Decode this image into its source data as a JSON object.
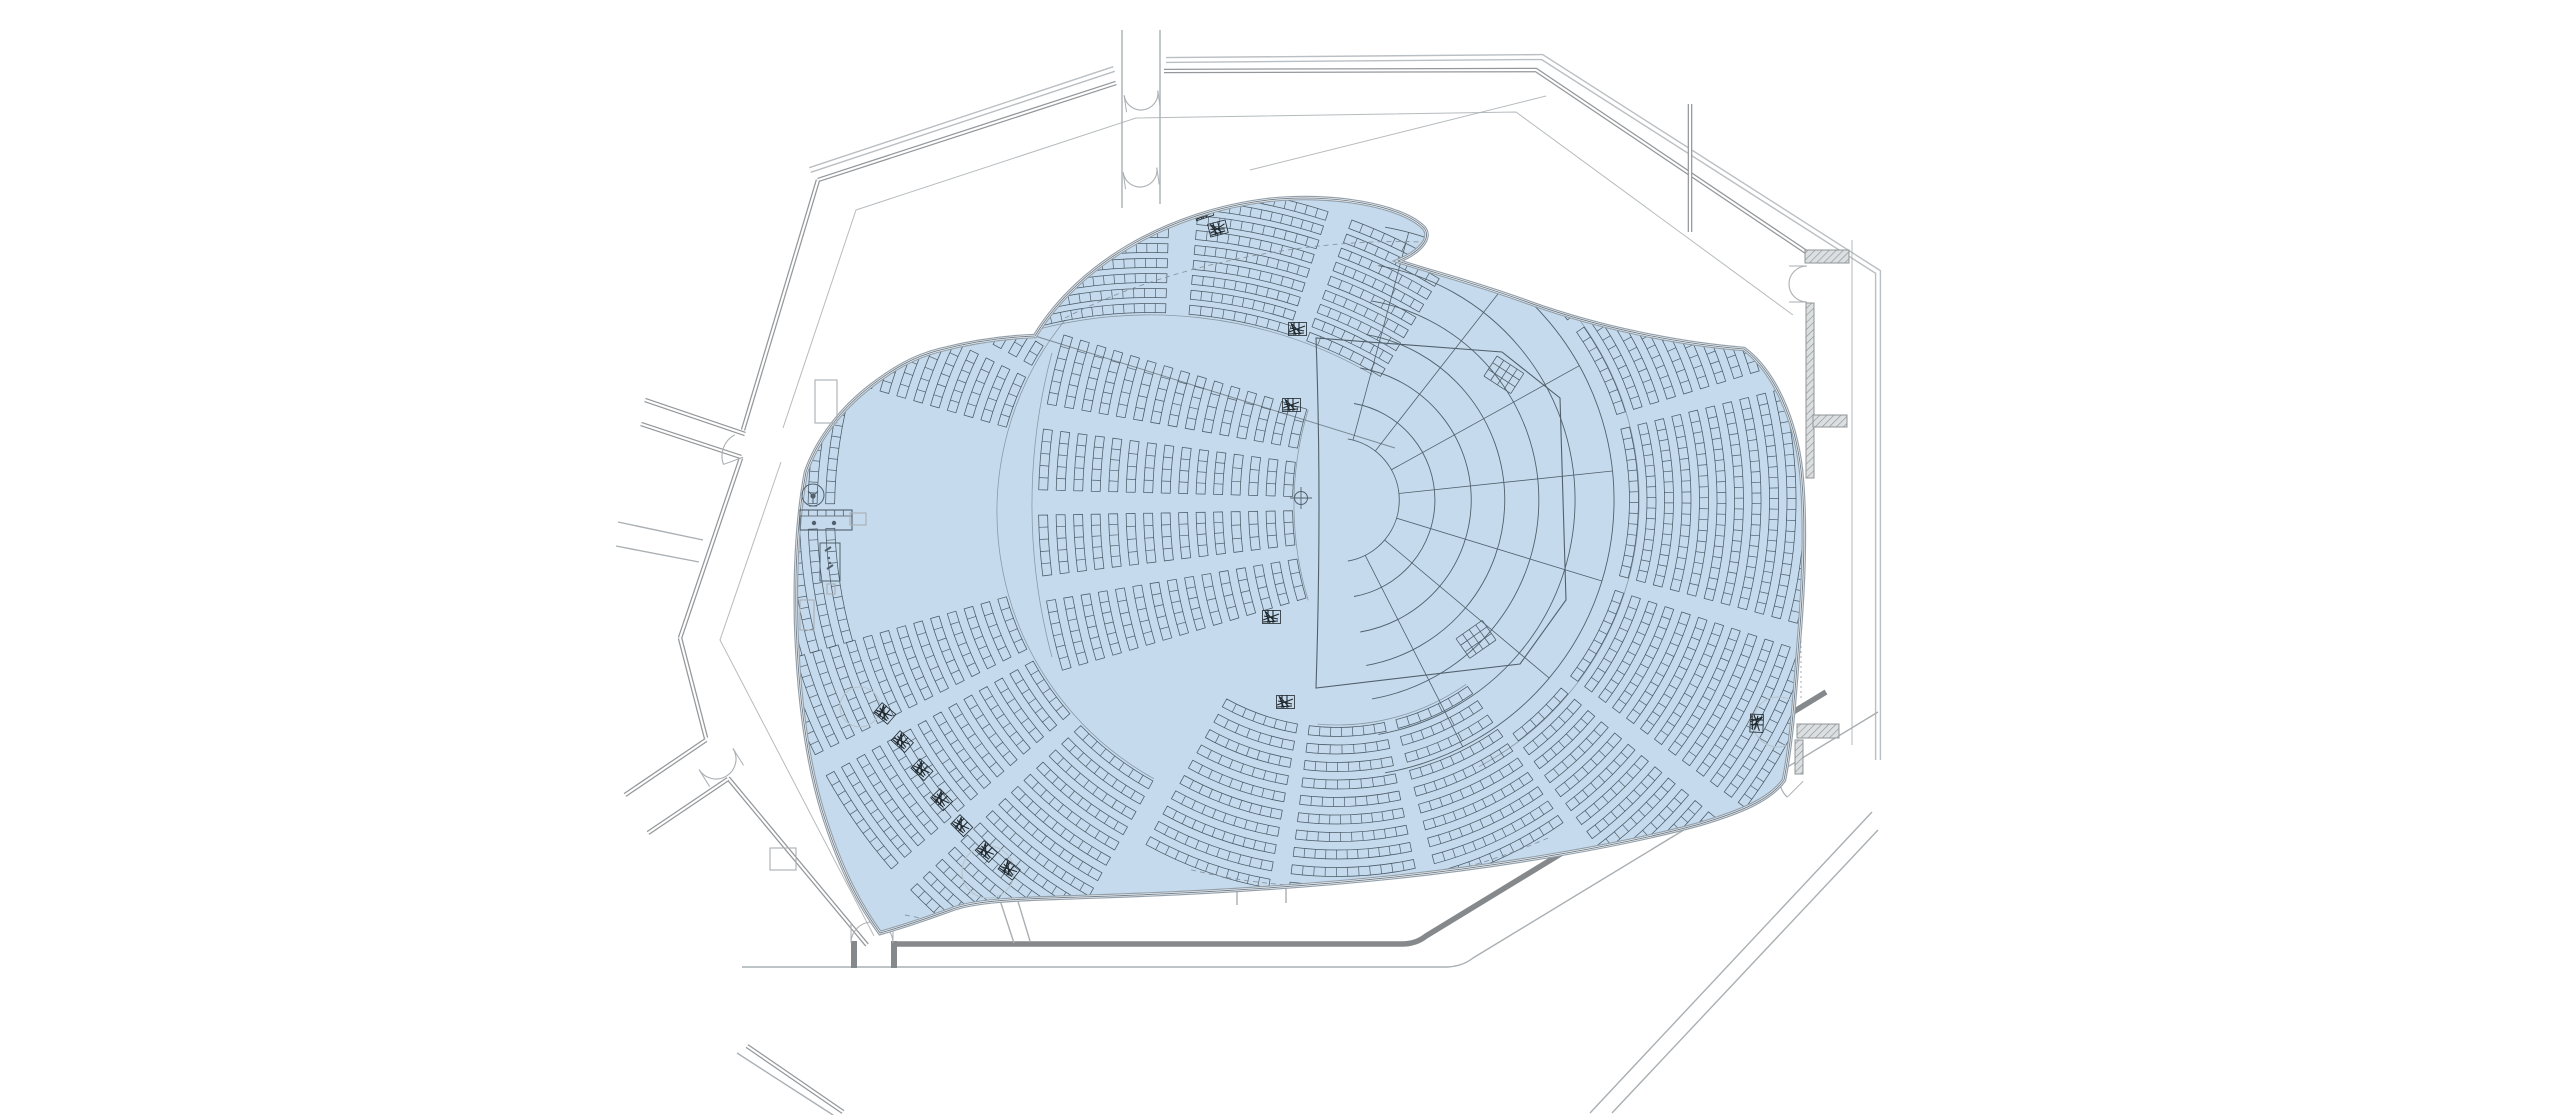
{
  "diagram": {
    "type": "architectural-floor-plan",
    "subject": "concert-hall-auditorium-seating-plan",
    "canvas": {
      "width": 2560,
      "height": 1115,
      "background": "#ffffff"
    },
    "colors": {
      "highlight_fill": "#c5dbed",
      "bowl_edge_outer": "#93a0ab",
      "bowl_edge_inner": "#74828e",
      "seat_line": "#3d4b58",
      "stage_line": "#51606c",
      "aisle_line": "#7b8a96",
      "wall_dark": "#85898c",
      "wall_mid": "#94989b",
      "wall_thin": "#a9afb3",
      "wall_skin": "#babfc3",
      "hatch_fill": "#dcdfe1",
      "hatch_line": "#8f9497",
      "dashed_line": "#8796a3",
      "scribble": "#20272d",
      "faint_circle": "#b6c3ce",
      "white": "#ffffff"
    },
    "bowl": {
      "path": "M1035,336 C1080,262 1170,212 1268,200 C1330,193 1402,205 1424,228 C1432,238 1420,252 1398,261 C1430,272 1470,281 1530,303 C1600,328 1680,344 1744,349 C1775,372 1795,420 1801,470 C1806,520 1804,580 1799,640 C1795,690 1792,740 1784,780 C1770,800 1740,812 1700,824 C1620,846 1500,866 1395,877 C1290,888 1180,894 1080,897 C1020,899 975,900 950,910 C928,918 898,928 880,933 C856,900 838,862 822,810 C806,756 798,690 796,620 C795,570 797,520 806,472 C818,438 842,408 872,385 C892,370 912,357 940,350 C975,341 1008,337 1035,336 Z"
    },
    "walls": [
      {
        "name": "skin-top-left",
        "style": "skin",
        "d": "M810,170 L1114,69"
      },
      {
        "name": "skin-top-right",
        "style": "skin",
        "d": "M1166,60 L1542,57 L1878,272 L1878,760"
      },
      {
        "name": "wall-top-left",
        "style": "dbl",
        "d": "M818,180 L1116,83"
      },
      {
        "name": "wall-top-right",
        "style": "dbl",
        "d": "M1164,71 L1536,70 L1821,262"
      },
      {
        "name": "wall-left-upper",
        "style": "dbl",
        "d": "M818,180 L743,430"
      },
      {
        "name": "wall-left-mid",
        "style": "dbl",
        "d": "M741,458 L680,638"
      },
      {
        "name": "wall-left-lower-a",
        "style": "dbl",
        "d": "M680,638 L706,738"
      },
      {
        "name": "wall-left-lower-b",
        "style": "dbl",
        "d": "M728,778 L867,945"
      },
      {
        "name": "corridor-upper-left-wall-a",
        "style": "dbl",
        "d": "M645,400 L745,434"
      },
      {
        "name": "corridor-upper-left-wall-b",
        "style": "dbl",
        "d": "M641,424 L741,457"
      },
      {
        "name": "corridor-left-horizontal-a",
        "style": "thin",
        "d": "M618,522 L703,540"
      },
      {
        "name": "corridor-left-horizontal-b",
        "style": "thin",
        "d": "M616,546 L699,562"
      },
      {
        "name": "corridor-lower-left-wall-a",
        "style": "dbl",
        "d": "M706,740 L625,795"
      },
      {
        "name": "corridor-lower-left-wall-b",
        "style": "dbl",
        "d": "M728,779 L648,833"
      },
      {
        "name": "wall-bottom-left-diag",
        "style": "dbl",
        "d": "M747,1046 L843,1112"
      },
      {
        "name": "wall-bottom-left-diag-thin",
        "style": "thin",
        "d": "M737,1053 L833,1115"
      },
      {
        "name": "corridor-top-wall-a",
        "style": "thin",
        "d": "M1122,30 L1122,208"
      },
      {
        "name": "corridor-top-wall-b",
        "style": "thin",
        "d": "M1160,30 L1160,204"
      },
      {
        "name": "band-bottom-dark",
        "style": "band",
        "d": "M897,944 L1402,944 Q1416,944 1426,936 L1826,692"
      },
      {
        "name": "band-bottom-thin",
        "style": "thin",
        "d": "M742,967 L1448,967 Q1463,966 1473,958 L1878,712"
      },
      {
        "name": "diag-bottom-right-a",
        "style": "thin",
        "d": "M1590,1113 L1872,812"
      },
      {
        "name": "diag-bottom-right-b",
        "style": "thin",
        "d": "M1612,1113 L1878,830"
      },
      {
        "name": "stub-bottom-center-a",
        "style": "thin",
        "d": "M1237,847 L1237,905"
      },
      {
        "name": "stub-bottom-center-b",
        "style": "thin",
        "d": "M1286,845 L1286,903"
      },
      {
        "name": "stub-bottom-diag-a",
        "style": "thin",
        "d": "M996,888 L1014,943"
      },
      {
        "name": "stub-bottom-diag-b",
        "style": "thin",
        "d": "M1013,885 L1030,941"
      },
      {
        "name": "foyer-line-top",
        "style": "foyer",
        "d": "M856,210 L1136,118 L1516,112 L1793,315"
      },
      {
        "name": "foyer-line-left-upper",
        "style": "foyer",
        "d": "M856,210 L783,428"
      },
      {
        "name": "foyer-line-left-lower",
        "style": "foyer",
        "d": "M781,462 L720,640 L874,936"
      },
      {
        "name": "foyer-line-top-right-diag",
        "style": "foyer",
        "d": "M1546,96 L1250,170"
      },
      {
        "name": "wall-interior-right",
        "style": "dbl",
        "d": "M1690,104 L1690,232"
      },
      {
        "name": "wall-right-thin-outer",
        "style": "foyer",
        "d": "M1852,240 L1852,745"
      },
      {
        "name": "dashes-right-edge",
        "style": "dash2",
        "d": "M1801,486 L1801,700"
      }
    ],
    "hatches": [
      {
        "x": 1805,
        "y": 250,
        "w": 44,
        "h": 13
      },
      {
        "x": 1806,
        "y": 303,
        "w": 8,
        "h": 175
      },
      {
        "x": 1813,
        "y": 415,
        "w": 34,
        "h": 12
      },
      {
        "x": 1797,
        "y": 724,
        "w": 42,
        "h": 14
      },
      {
        "x": 1795,
        "y": 740,
        "w": 8,
        "h": 34
      }
    ],
    "doors": [
      {
        "name": "door-top-corridor-upper",
        "x": 1141,
        "y": 93,
        "w": 34,
        "rot": 172,
        "double": true
      },
      {
        "name": "door-top-corridor-lower",
        "x": 1140,
        "y": 170,
        "w": 34,
        "rot": 172,
        "double": true
      },
      {
        "name": "door-left-upper",
        "x": 739,
        "y": 446,
        "w": 24,
        "rot": 250,
        "double": false
      },
      {
        "name": "door-left-mid",
        "x": 716,
        "y": 759,
        "w": 40,
        "rot": 148,
        "double": true
      },
      {
        "name": "door-bottom-left",
        "x": 872,
        "y": 943,
        "w": 42,
        "rot": 0,
        "double": true
      },
      {
        "name": "door-right-upper",
        "x": 1807,
        "y": 284,
        "w": 36,
        "rot": 270,
        "double": true
      },
      {
        "name": "door-right-lower",
        "x": 1794,
        "y": 772,
        "w": 26,
        "rot": 225,
        "double": false
      }
    ],
    "jambs": [
      {
        "x": 851,
        "y": 941,
        "w": 6,
        "h": 27
      },
      {
        "x": 891,
        "y": 941,
        "w": 6,
        "h": 27
      }
    ],
    "stage": {
      "center": [
        1337,
        500
      ],
      "crosshair": [
        1301,
        498
      ],
      "plate_path": "M1316,338 Q1322,500 1316,688 L1520,664 L1566,600 L1560,398 L1502,352 Z",
      "terrace_radii": [
        62,
        98,
        134,
        168,
        202,
        238,
        277
      ],
      "terrace_angle_range": [
        -80,
        80
      ],
      "radial_angles": [
        -75,
        -52,
        -29,
        -6,
        17,
        40,
        63
      ],
      "grids": [
        {
          "x": 1497,
          "y": 356,
          "rot": 33
        },
        {
          "x": 1496,
          "y": 640,
          "rot": 145
        }
      ]
    },
    "aisle_arcs": [
      {
        "cx": 1337,
        "cy": 500,
        "r": 302,
        "a0": -62,
        "a1": 62
      },
      {
        "cx": 1337,
        "cy": 500,
        "r": 225,
        "a0": 55,
        "a1": 95
      },
      {
        "cx": 1302,
        "cy": 512,
        "r": 305,
        "a0": 119,
        "a1": 219
      },
      {
        "cx": 1620,
        "cy": 505,
        "r": 326,
        "a0": 163,
        "a1": 197
      },
      {
        "cx": 1620,
        "cy": 505,
        "r": 588,
        "a0": 165,
        "a1": 195
      },
      {
        "cx": 1150,
        "cy": 760,
        "r": 445,
        "a0": -107,
        "a1": -60
      },
      {
        "cx": 1150,
        "cy": 760,
        "r": 578,
        "a0": -104,
        "a1": -80
      }
    ],
    "wing_boundary": "M1035,336 L1395,448",
    "dashed_paths": [
      "M1065,318 C1180,258 1330,238 1421,242",
      "M1548,838 Q1372,915 1188,869",
      "M905,915 C1100,955 1420,935 1690,838"
    ],
    "seating_style": {
      "strip_halfwidth": 4.5,
      "seat_pitch": 10.5,
      "row_step": 17.5
    },
    "seating_sections": [
      {
        "name": "orchestra-center",
        "cx": 1620,
        "cy": 505,
        "r0": 332,
        "r1": 582,
        "a0": 163.5,
        "a1": 197,
        "aisles": [
          [
            170.5,
            173
          ],
          [
            179,
            181.5
          ],
          [
            187.5,
            190
          ]
        ]
      },
      {
        "name": "orchestra-left-lower",
        "cx": 1302,
        "cy": 512,
        "r0": 312,
        "r1": 544,
        "a0": 119,
        "a1": 164,
        "aisles": [
          [
            136,
            139
          ],
          [
            151,
            153.5
          ]
        ]
      },
      {
        "name": "orchestra-left-outer",
        "cx": 1302,
        "cy": 512,
        "r0": 472,
        "r1": 544,
        "a0": 164,
        "a1": 196,
        "aisles": [
          [
            178,
            181
          ]
        ]
      },
      {
        "name": "orchestra-left-upper",
        "cx": 1302,
        "cy": 512,
        "r0": 312,
        "r1": 544,
        "a0": 196,
        "a1": 219,
        "aisles": [
          [
            206,
            208.5
          ]
        ],
        "clip": {
          "x1": 1035,
          "y1": 336,
          "x2": 1395,
          "y2": 448,
          "keep": "below",
          "xmin": 1035
        }
      },
      {
        "name": "terrace-below-stage",
        "cx": 1337,
        "cy": 500,
        "r0": 232,
        "r1": 392,
        "a0": 55,
        "a1": 119,
        "aisles": [
          [
            75,
            78
          ],
          [
            97,
            100
          ]
        ]
      },
      {
        "name": "terrace-right",
        "cx": 1337,
        "cy": 500,
        "r0": 297,
        "r1": 507,
        "a0": -62,
        "a1": 53,
        "aisles": [
          [
            -38,
            -35
          ],
          [
            -17,
            -14
          ],
          [
            15,
            18
          ],
          [
            37,
            40
          ]
        ]
      },
      {
        "name": "balcony-wing",
        "cx": 1150,
        "cy": 760,
        "r0": 452,
        "r1": 572,
        "rstep": 15,
        "a0": -108,
        "a1": -59,
        "aisles": [
          [
            -88,
            -85
          ],
          [
            -72,
            -69.5
          ]
        ],
        "clip": {
          "x1": 1035,
          "y1": 336,
          "x2": 1395,
          "y2": 448,
          "keep": "above",
          "xmin": 1000
        }
      }
    ],
    "scribbles": [
      [
        1192,
        208,
        -18
      ],
      [
        1207,
        224,
        -14
      ],
      [
        1288,
        322,
        0
      ],
      [
        1282,
        398,
        0
      ],
      [
        1262,
        610,
        0
      ],
      [
        1276,
        695,
        0
      ],
      [
        882,
        702,
        40
      ],
      [
        900,
        730,
        42
      ],
      [
        920,
        758,
        44
      ],
      [
        940,
        788,
        46
      ],
      [
        960,
        814,
        45
      ],
      [
        984,
        840,
        42
      ],
      [
        1006,
        858,
        38
      ],
      [
        1768,
        318,
        88
      ],
      [
        1764,
        714,
        92
      ]
    ],
    "fixtures": [
      {
        "type": "gauge",
        "name": "console-gauge",
        "x": 813,
        "y": 495
      },
      {
        "type": "panel",
        "name": "control-panel",
        "x": 800,
        "y": 510,
        "w": 52,
        "h": 20
      },
      {
        "type": "smallrect",
        "name": "panel-extension",
        "x": 850,
        "y": 513,
        "w": 16,
        "h": 12
      },
      {
        "type": "cabinet",
        "name": "cabinet-fixture",
        "x": 820,
        "y": 543,
        "w": 20,
        "h": 38
      },
      {
        "type": "smallrect",
        "name": "cabinet-base",
        "x": 827,
        "y": 584,
        "w": 8,
        "h": 10
      },
      {
        "type": "smallrect",
        "name": "left-closet",
        "x": 800,
        "y": 600,
        "w": 14,
        "h": 30
      },
      {
        "type": "smallrect",
        "name": "upper-closet",
        "x": 815,
        "y": 380,
        "w": 22,
        "h": 43
      },
      {
        "type": "smallrect",
        "name": "lower-left-closet",
        "x": 770,
        "y": 848,
        "w": 26,
        "h": 22
      }
    ],
    "faint_circles": [
      [
        860,
        707,
        20
      ],
      [
        988,
        872,
        26
      ],
      [
        1082,
        170,
        22
      ],
      [
        1776,
        309,
        14
      ],
      [
        1778,
        722,
        25
      ]
    ]
  }
}
